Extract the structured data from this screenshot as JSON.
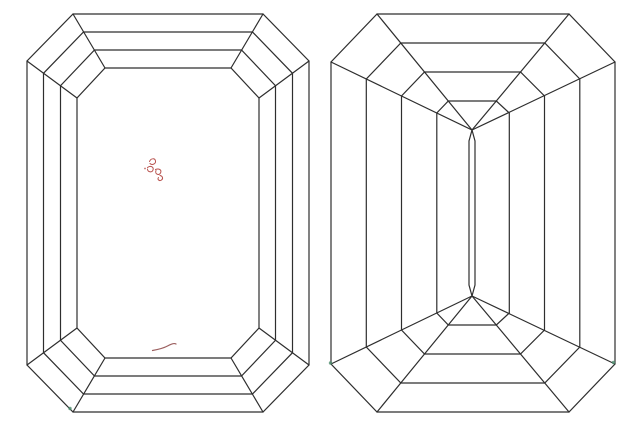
{
  "colors": {
    "background": "#ffffff",
    "outline": "#2e2e2e",
    "inclusion_red": "#b8524e",
    "inclusion_maroon": "#9c6060",
    "natural_green": "#4d8d6e"
  },
  "diagram": {
    "views": [
      {
        "id": "crown-view"
      },
      {
        "id": "pavilion-view"
      }
    ],
    "plot_marks": [
      {
        "type": "crystal-cluster-scribble",
        "view": "crown-view",
        "color": "inclusion_red",
        "x": 153,
        "y": 169
      },
      {
        "type": "needle-curve-mark",
        "view": "crown-view",
        "color": "inclusion_maroon",
        "x": 164,
        "y": 347
      },
      {
        "type": "natural-dot",
        "view": "crown-view",
        "color": "natural_green",
        "x": 70,
        "y": 408
      },
      {
        "type": "natural-dot",
        "view": "pavilion-view",
        "color": "natural_green",
        "x": 330,
        "y": 363
      },
      {
        "type": "natural-dot",
        "view": "pavilion-view",
        "color": "natural_green",
        "x": 613,
        "y": 362
      }
    ]
  }
}
